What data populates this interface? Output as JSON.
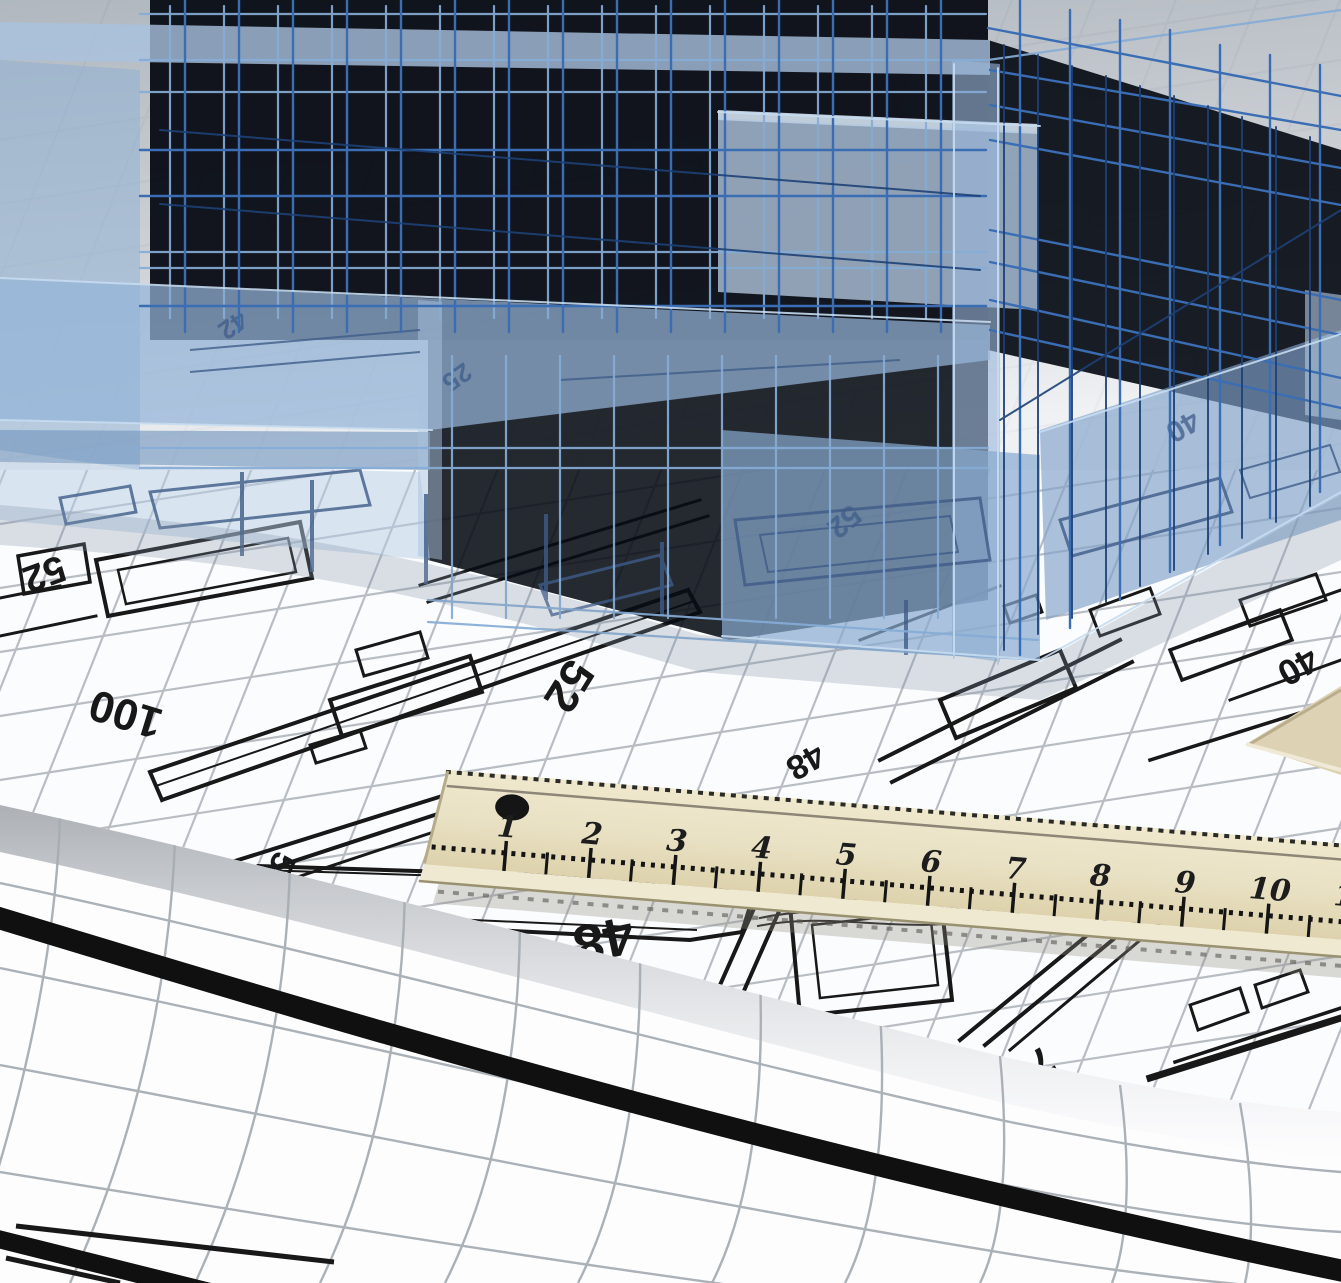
{
  "scene": {
    "kind": "photo",
    "subject": "3D wireframe building model standing on architectural blueprints with a wooden ruler and rolled plan sheet"
  },
  "colors": {
    "glass_blue": "#8fb0d4",
    "wire_blue": "#3a6db3",
    "wire_light": "#86abd6",
    "wire_dark": "#1d4076",
    "interior_dark": "#070b13",
    "paper_white": "#fbfcfd",
    "grid_gray": "#b5b9c0",
    "plan_ink": "#181818",
    "ghost_ink": "#3f5c88",
    "ruler_wood": "#e9e1c4",
    "ruler_ink": "#1d1d1d",
    "roll_band_black": "#101010",
    "backdrop_gray": "#aab2ba"
  },
  "blueprint": {
    "labels": [
      "52",
      "100",
      "52",
      "48",
      "48",
      "40",
      "5",
      "7"
    ],
    "ghost_labels": [
      "40",
      "42",
      "25",
      "52"
    ]
  },
  "ruler": {
    "numbers": [
      "1",
      "2",
      "3",
      "4",
      "5",
      "6",
      "7",
      "8",
      "9",
      "10",
      "11"
    ]
  }
}
